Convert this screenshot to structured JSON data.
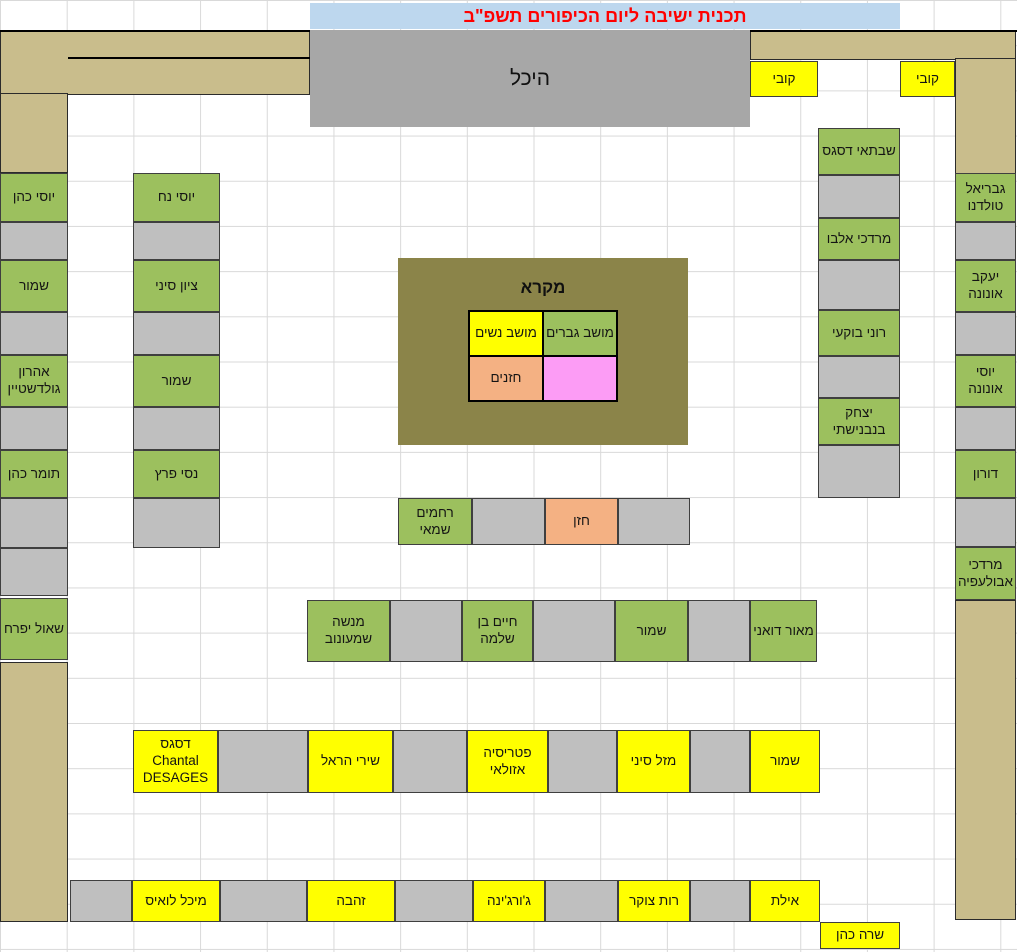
{
  "title": {
    "text": "תכנית ישיבה ליום הכיפורים תשפ\"ב"
  },
  "heichal_label": "היכל",
  "legend": {
    "title": "מקרא",
    "men_label": "מושב גברים",
    "women_label": "מושב נשים",
    "cantor_label": "חזנים",
    "reserved_label": ""
  },
  "colors": {
    "men": "#9CC05E",
    "women": "#FFFF00",
    "empty": "#BFBFBF",
    "cantor": "#F4B183",
    "pink": "#FC9CF5",
    "wall": "#C9BD8C",
    "heichal_bg": "#A7A7A7",
    "legend_bg": "#8B8449",
    "title_bg": "#BDD7EE",
    "title_color": "#FF0000"
  },
  "walls": [
    {
      "x": 0,
      "y": 30,
      "w": 310,
      "h": 65
    },
    {
      "x": 0,
      "y": 93,
      "w": 68,
      "h": 80
    },
    {
      "x": 750,
      "y": 30,
      "w": 266,
      "h": 30
    },
    {
      "x": 955,
      "y": 58,
      "w": 61,
      "h": 116
    },
    {
      "x": 0,
      "y": 662,
      "w": 68,
      "h": 260
    },
    {
      "x": 955,
      "y": 600,
      "w": 61,
      "h": 320
    }
  ],
  "seats": [
    {
      "x": 750,
      "y": 61,
      "w": 68,
      "h": 36,
      "type": "women",
      "label": "קובי"
    },
    {
      "x": 900,
      "y": 61,
      "w": 55,
      "h": 36,
      "type": "women",
      "label": "קובי"
    },
    {
      "x": 0,
      "y": 173,
      "w": 68,
      "h": 49,
      "type": "men",
      "label": "יוסי כהן"
    },
    {
      "x": 0,
      "y": 222,
      "w": 68,
      "h": 38,
      "type": "empty",
      "label": ""
    },
    {
      "x": 0,
      "y": 260,
      "w": 68,
      "h": 52,
      "type": "men",
      "label": "שמור"
    },
    {
      "x": 0,
      "y": 312,
      "w": 68,
      "h": 43,
      "type": "empty",
      "label": ""
    },
    {
      "x": 0,
      "y": 355,
      "w": 68,
      "h": 52,
      "type": "men",
      "label": "אהרון גולדשטיין"
    },
    {
      "x": 0,
      "y": 407,
      "w": 68,
      "h": 43,
      "type": "empty",
      "label": ""
    },
    {
      "x": 0,
      "y": 450,
      "w": 68,
      "h": 48,
      "type": "men",
      "label": "תומר כהן"
    },
    {
      "x": 0,
      "y": 498,
      "w": 68,
      "h": 50,
      "type": "empty",
      "label": ""
    },
    {
      "x": 0,
      "y": 548,
      "w": 68,
      "h": 48,
      "type": "empty",
      "label": ""
    },
    {
      "x": 0,
      "y": 598,
      "w": 68,
      "h": 62,
      "type": "men",
      "label": "שאול יפרח"
    },
    {
      "x": 133,
      "y": 173,
      "w": 87,
      "h": 49,
      "type": "men",
      "label": "יוסי נח"
    },
    {
      "x": 133,
      "y": 222,
      "w": 87,
      "h": 38,
      "type": "empty",
      "label": ""
    },
    {
      "x": 133,
      "y": 260,
      "w": 87,
      "h": 52,
      "type": "men",
      "label": "ציון סיני"
    },
    {
      "x": 133,
      "y": 312,
      "w": 87,
      "h": 43,
      "type": "empty",
      "label": ""
    },
    {
      "x": 133,
      "y": 355,
      "w": 87,
      "h": 52,
      "type": "men",
      "label": "שמור"
    },
    {
      "x": 133,
      "y": 407,
      "w": 87,
      "h": 43,
      "type": "empty",
      "label": ""
    },
    {
      "x": 133,
      "y": 450,
      "w": 87,
      "h": 48,
      "type": "men",
      "label": "נסי פרץ"
    },
    {
      "x": 133,
      "y": 498,
      "w": 87,
      "h": 50,
      "type": "empty",
      "label": ""
    },
    {
      "x": 818,
      "y": 128,
      "w": 82,
      "h": 47,
      "type": "men",
      "label": "שבתאי דסגס"
    },
    {
      "x": 818,
      "y": 175,
      "w": 82,
      "h": 43,
      "type": "empty",
      "label": ""
    },
    {
      "x": 818,
      "y": 218,
      "w": 82,
      "h": 42,
      "type": "men",
      "label": "מרדכי אלבו"
    },
    {
      "x": 818,
      "y": 260,
      "w": 82,
      "h": 50,
      "type": "empty",
      "label": ""
    },
    {
      "x": 818,
      "y": 310,
      "w": 82,
      "h": 46,
      "type": "men",
      "label": "רוני בוקעי"
    },
    {
      "x": 818,
      "y": 356,
      "w": 82,
      "h": 42,
      "type": "empty",
      "label": ""
    },
    {
      "x": 818,
      "y": 398,
      "w": 82,
      "h": 47,
      "type": "men",
      "label": "יצחק בנבנישתי"
    },
    {
      "x": 818,
      "y": 445,
      "w": 82,
      "h": 53,
      "type": "empty",
      "label": ""
    },
    {
      "x": 955,
      "y": 173,
      "w": 61,
      "h": 49,
      "type": "men",
      "label": "גבריאל טולדנו"
    },
    {
      "x": 955,
      "y": 222,
      "w": 61,
      "h": 38,
      "type": "empty",
      "label": ""
    },
    {
      "x": 955,
      "y": 260,
      "w": 61,
      "h": 52,
      "type": "men",
      "label": "יעקב אונונה"
    },
    {
      "x": 955,
      "y": 312,
      "w": 61,
      "h": 43,
      "type": "empty",
      "label": ""
    },
    {
      "x": 955,
      "y": 355,
      "w": 61,
      "h": 52,
      "type": "men",
      "label": "יוסי אונונה"
    },
    {
      "x": 955,
      "y": 407,
      "w": 61,
      "h": 43,
      "type": "empty",
      "label": ""
    },
    {
      "x": 955,
      "y": 450,
      "w": 61,
      "h": 48,
      "type": "men",
      "label": "דורון"
    },
    {
      "x": 955,
      "y": 498,
      "w": 61,
      "h": 49,
      "type": "empty",
      "label": ""
    },
    {
      "x": 955,
      "y": 547,
      "w": 61,
      "h": 53,
      "type": "men",
      "label": "מרדכי אבולעפיה"
    },
    {
      "x": 398,
      "y": 498,
      "w": 74,
      "h": 47,
      "type": "men",
      "label": "רחמים שמאי"
    },
    {
      "x": 472,
      "y": 498,
      "w": 73,
      "h": 47,
      "type": "empty",
      "label": ""
    },
    {
      "x": 545,
      "y": 498,
      "w": 73,
      "h": 47,
      "type": "cantor",
      "label": "חזן"
    },
    {
      "x": 618,
      "y": 498,
      "w": 72,
      "h": 47,
      "type": "empty",
      "label": ""
    },
    {
      "x": 307,
      "y": 600,
      "w": 83,
      "h": 62,
      "type": "men",
      "label": "מנשה שמעונוב"
    },
    {
      "x": 390,
      "y": 600,
      "w": 72,
      "h": 62,
      "type": "empty",
      "label": ""
    },
    {
      "x": 462,
      "y": 600,
      "w": 71,
      "h": 62,
      "type": "men",
      "label": "חיים בן שלמה"
    },
    {
      "x": 533,
      "y": 600,
      "w": 82,
      "h": 62,
      "type": "empty",
      "label": ""
    },
    {
      "x": 615,
      "y": 600,
      "w": 73,
      "h": 62,
      "type": "men",
      "label": "שמור"
    },
    {
      "x": 688,
      "y": 600,
      "w": 62,
      "h": 62,
      "type": "empty",
      "label": ""
    },
    {
      "x": 750,
      "y": 600,
      "w": 67,
      "h": 62,
      "type": "men",
      "label": "מאור דואני"
    },
    {
      "x": 133,
      "y": 730,
      "w": 85,
      "h": 63,
      "type": "women",
      "label": "דסגס\nChantal\nDESAGES"
    },
    {
      "x": 218,
      "y": 730,
      "w": 90,
      "h": 63,
      "type": "empty",
      "label": ""
    },
    {
      "x": 308,
      "y": 730,
      "w": 85,
      "h": 63,
      "type": "women",
      "label": "שירי הראל"
    },
    {
      "x": 393,
      "y": 730,
      "w": 74,
      "h": 63,
      "type": "empty",
      "label": ""
    },
    {
      "x": 467,
      "y": 730,
      "w": 81,
      "h": 63,
      "type": "women",
      "label": "פטריסיה אזולאי"
    },
    {
      "x": 548,
      "y": 730,
      "w": 69,
      "h": 63,
      "type": "empty",
      "label": ""
    },
    {
      "x": 617,
      "y": 730,
      "w": 73,
      "h": 63,
      "type": "women",
      "label": "מזל סיני"
    },
    {
      "x": 690,
      "y": 730,
      "w": 60,
      "h": 63,
      "type": "empty",
      "label": ""
    },
    {
      "x": 750,
      "y": 730,
      "w": 70,
      "h": 63,
      "type": "women",
      "label": "שמור"
    },
    {
      "x": 70,
      "y": 880,
      "w": 62,
      "h": 42,
      "type": "empty",
      "label": ""
    },
    {
      "x": 132,
      "y": 880,
      "w": 88,
      "h": 42,
      "type": "women",
      "label": "מיכל לואיס"
    },
    {
      "x": 220,
      "y": 880,
      "w": 87,
      "h": 42,
      "type": "empty",
      "label": ""
    },
    {
      "x": 307,
      "y": 880,
      "w": 88,
      "h": 42,
      "type": "women",
      "label": "זהבה"
    },
    {
      "x": 395,
      "y": 880,
      "w": 78,
      "h": 42,
      "type": "empty",
      "label": ""
    },
    {
      "x": 473,
      "y": 880,
      "w": 72,
      "h": 42,
      "type": "women",
      "label": "ג'ורג'ינה"
    },
    {
      "x": 545,
      "y": 880,
      "w": 73,
      "h": 42,
      "type": "empty",
      "label": ""
    },
    {
      "x": 618,
      "y": 880,
      "w": 72,
      "h": 42,
      "type": "women",
      "label": "רות צוקר"
    },
    {
      "x": 690,
      "y": 880,
      "w": 60,
      "h": 42,
      "type": "empty",
      "label": ""
    },
    {
      "x": 750,
      "y": 880,
      "w": 70,
      "h": 42,
      "type": "women",
      "label": "אילת"
    },
    {
      "x": 820,
      "y": 922,
      "w": 80,
      "h": 27,
      "type": "women",
      "label": "שרה כהן"
    }
  ]
}
